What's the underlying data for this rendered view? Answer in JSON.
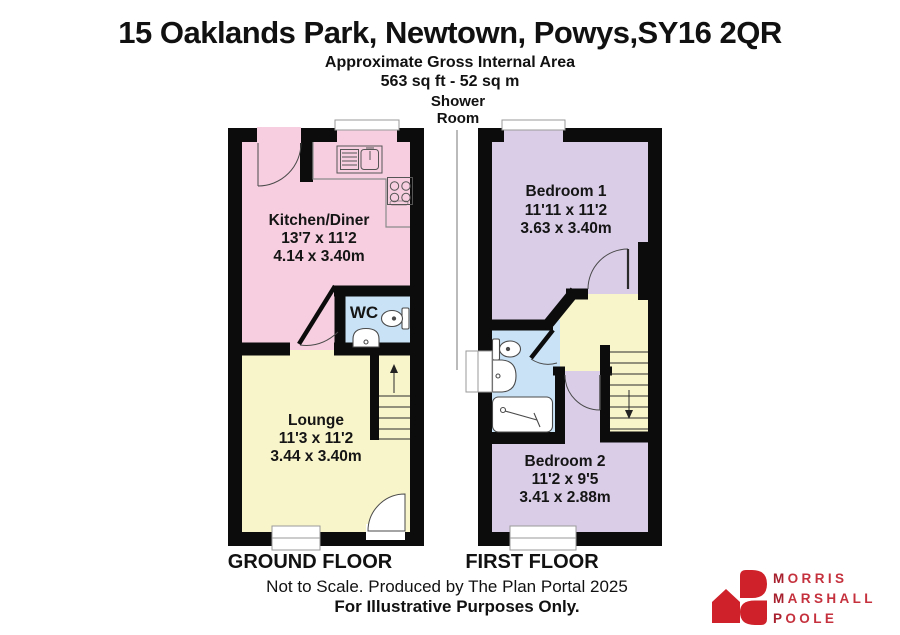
{
  "header": {
    "title": "15 Oaklands Park, Newtown, Powys,SY16 2QR",
    "area_label": "Approximate Gross Internal Area",
    "area_value": "563 sq ft - 52 sq m"
  },
  "callout": {
    "line1": "Shower",
    "line2": "Room"
  },
  "ground_floor": {
    "caption": "GROUND FLOOR",
    "kitchen": {
      "name": "Kitchen/Diner",
      "imperial": "13'7 x 11'2",
      "metric": "4.14 x 3.40m"
    },
    "wc": {
      "name": "WC"
    },
    "lounge": {
      "name": "Lounge",
      "imperial": "11'3 x 11'2",
      "metric": "3.44 x 3.40m"
    }
  },
  "first_floor": {
    "caption": "FIRST FLOOR",
    "bedroom1": {
      "name": "Bedroom 1",
      "imperial": "11'11 x 11'2",
      "metric": "3.63 x 3.40m"
    },
    "bedroom2": {
      "name": "Bedroom 2",
      "imperial": "11'2 x 9'5",
      "metric": "3.41 x 2.88m"
    }
  },
  "footer": {
    "note": "Not to Scale. Produced by The Plan Portal 2025",
    "disclaimer": "For Illustrative Purposes Only."
  },
  "logo": {
    "line1": "MORRIS",
    "line2": "MARSHALL",
    "line3": "POOLE"
  },
  "colors": {
    "kitchen": "#F6CEDF",
    "wc": "#C9E2F6",
    "lounge": "#F9F5CA",
    "landing": "#F9F5CA",
    "bedroom": "#DACDE8",
    "wall": "#0C0C0C",
    "window_trim": "#9A9A9A",
    "logo_red": "#CE2129",
    "logo_text_red": "#C5323E"
  }
}
